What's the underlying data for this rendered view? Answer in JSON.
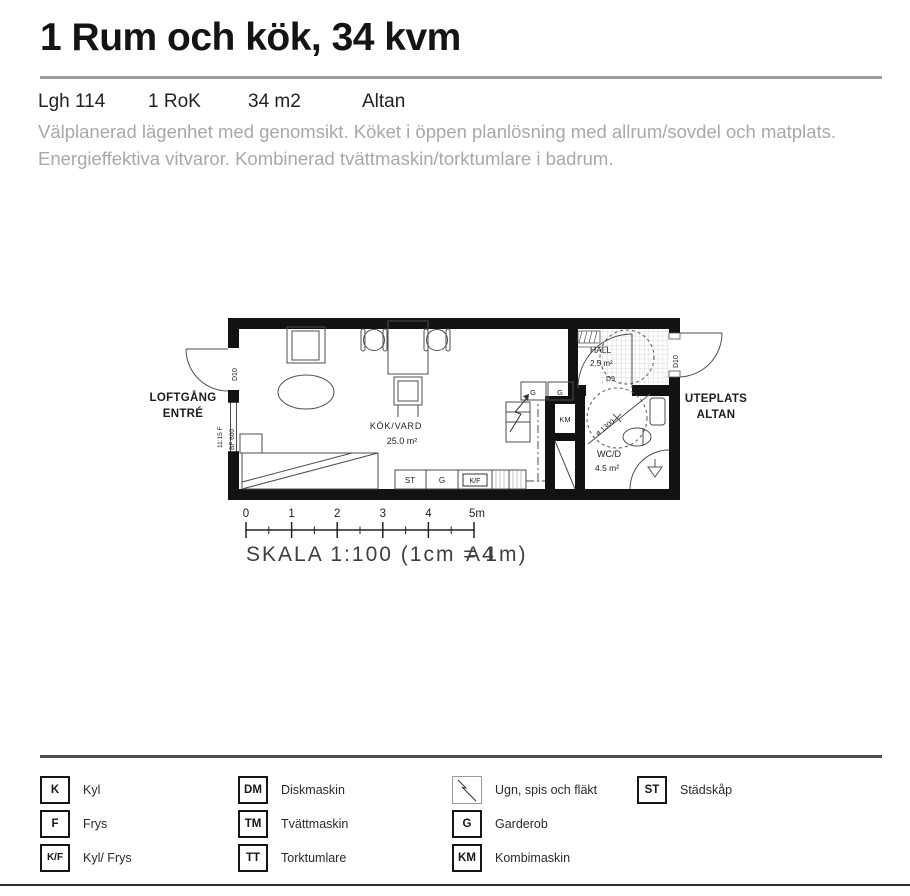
{
  "header": {
    "title": "1 Rum och kök, 34 kvm",
    "info": [
      {
        "label": "Lgh 114"
      },
      {
        "label": "1 RoK"
      },
      {
        "label": "34 m2"
      },
      {
        "label": "Altan"
      }
    ],
    "description_line1": "Välplanerad lägenhet med genomsikt. Köket i öppen planlösning med allrum/sovdel och matplats.",
    "description_line2": "Energieffektiva vitvaror. Kombinerad tvättmaskin/torktumlare i badrum."
  },
  "floorplan": {
    "areas": {
      "left_line1": "LOFTGÅNG",
      "left_line2": "ENTRÉ",
      "right_line1": "UTEPLATS",
      "right_line2": "ALTAN",
      "main_room": "KÖK/VARD",
      "main_room_area": "25.0 m²",
      "hall": "HALL",
      "hall_area": "2.5 m²",
      "wc": "WC/D",
      "wc_area": "4.5 m²"
    },
    "marks": {
      "door_left": "D10",
      "door_right": "D10",
      "door_wc": "D9",
      "window_line1": "11:15 F",
      "window_line2": "BF 600",
      "turning_circle": "ø 1300",
      "km": "KM",
      "closet_g1": "G",
      "closet_g2": "G",
      "kitchen_st": "ST",
      "kitchen_g": "G",
      "kitchen_kf": "K/F"
    },
    "scale_bar_ticks": [
      "0",
      "1",
      "2",
      "3",
      "4",
      "5m"
    ],
    "scale_text": "SKALA 1:100 (1cm = 1m)",
    "paper_size": "A4"
  },
  "legend": {
    "items": [
      {
        "code": "K",
        "label": "Kyl"
      },
      {
        "code": "F",
        "label": "Frys"
      },
      {
        "code": "K/F",
        "label": "Kyl/ Frys"
      },
      {
        "code": "DM",
        "label": "Diskmaskin"
      },
      {
        "code": "TM",
        "label": "Tvättmaskin"
      },
      {
        "code": "TT",
        "label": "Torktumlare"
      },
      {
        "code": "",
        "label": "Ugn, spis och fläkt",
        "icon": "stove-diagonal-icon"
      },
      {
        "code": "G",
        "label": "Garderob"
      },
      {
        "code": "KM",
        "label": "Kombimaskin"
      },
      {
        "code": "ST",
        "label": "Städskåp"
      }
    ]
  },
  "colors": {
    "wall_black": "#121212",
    "title_rule_gray": "#9c9c9c",
    "legend_rule_dark": "#4f4f4f",
    "muted_text": "#a8a8a8"
  }
}
